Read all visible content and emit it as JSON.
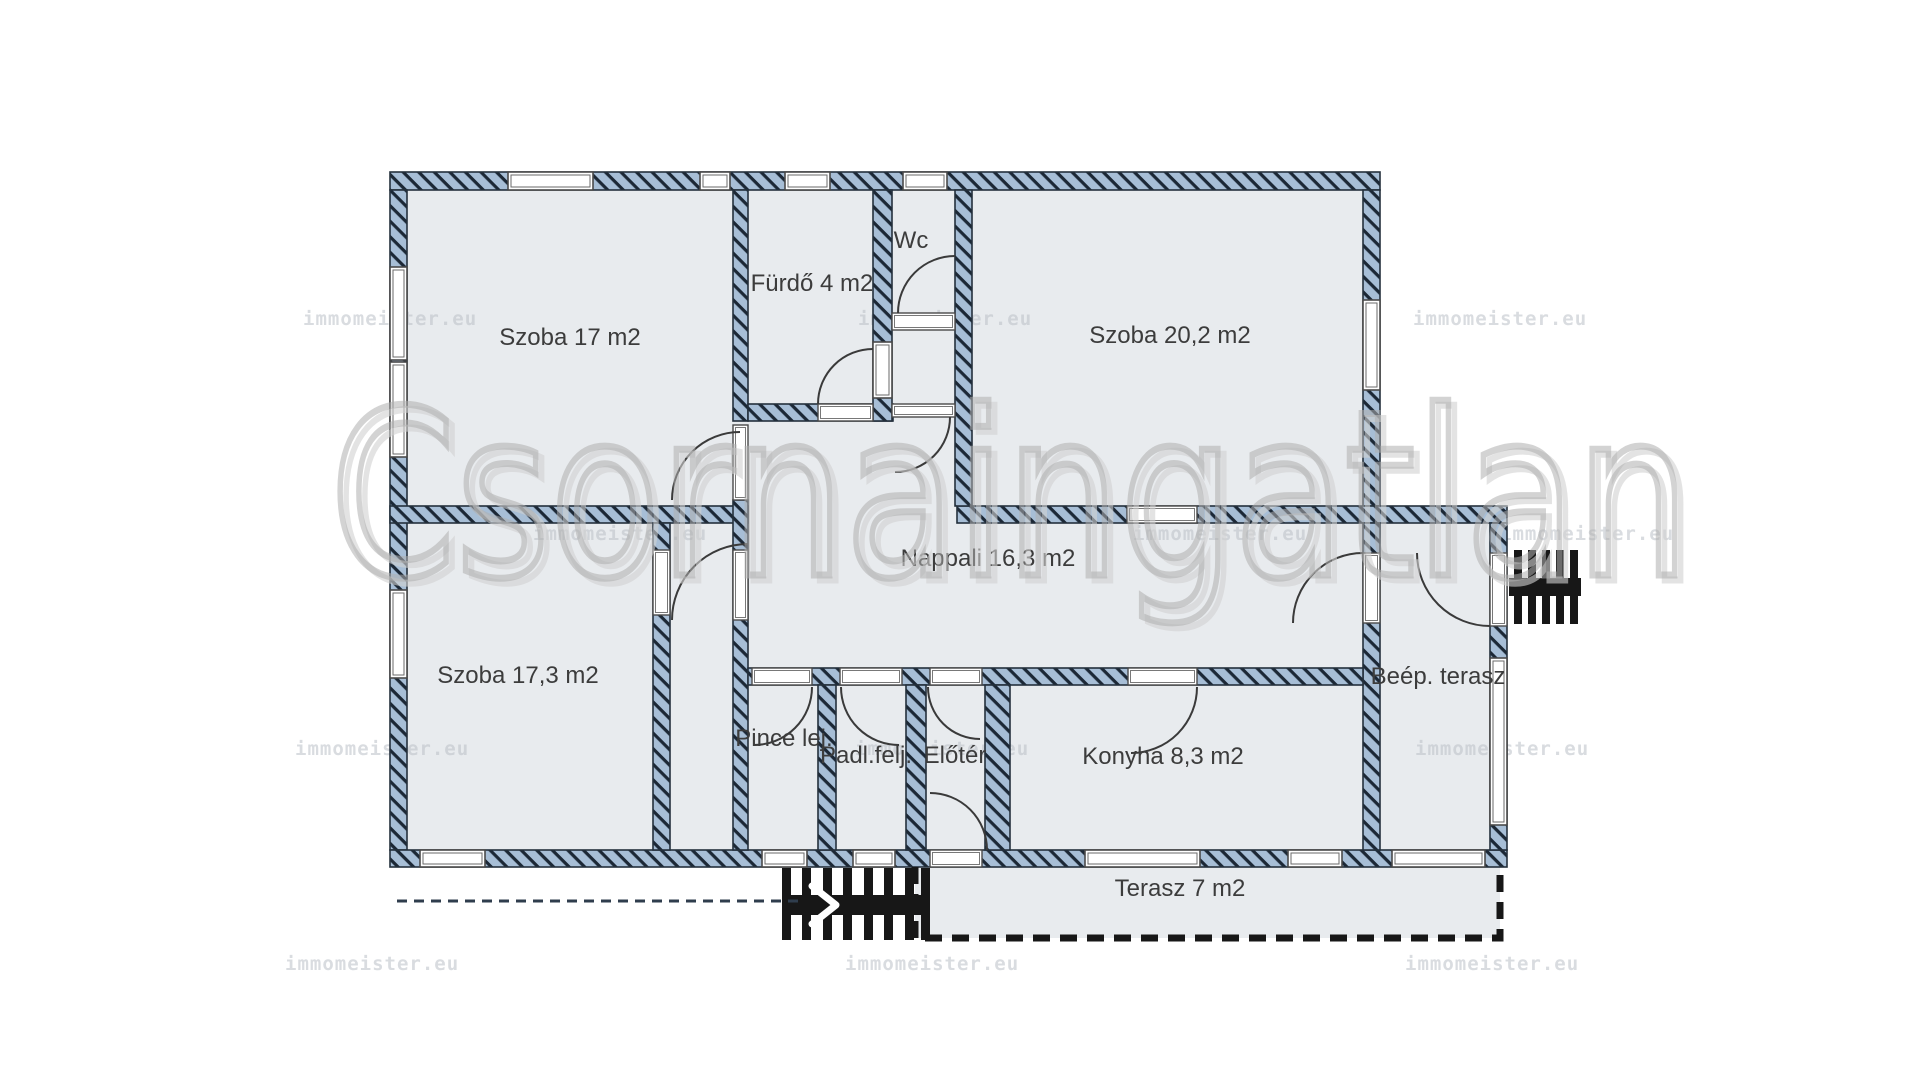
{
  "document": {
    "title": "Floor plan"
  },
  "colors": {
    "page_bg": "#ffffff",
    "room_fill": "#e8ebee",
    "wall_fill": "#a7bed6",
    "hatch_line": "#1c2836",
    "wall_stroke": "#24303c",
    "frame_stroke": "#4a4a4a",
    "frame_inner": "#6a6a6a",
    "arc_stroke": "#3a3a3a",
    "label_color": "#3c3c3c",
    "black": "#171717",
    "path_line": "#2f3d4d",
    "watermark_main": "#b0b0b0",
    "watermark_shadow": "#d2d2d2",
    "watermark_small": "rgba(185,192,199,0.55)"
  },
  "watermark": {
    "brand_text": "Csornaingatlan",
    "brand_x": 1010,
    "brand_y": 575,
    "brand_size": 230,
    "brand_length": 1360,
    "small_text": "immomeister.eu",
    "small_size": 19,
    "small_rows": [
      {
        "y": 325,
        "xs": [
          303,
          858,
          1413
        ]
      },
      {
        "y": 540,
        "xs": [
          533,
          1133,
          1500
        ]
      },
      {
        "y": 755,
        "xs": [
          295,
          855,
          1415
        ]
      },
      {
        "y": 970,
        "xs": [
          285,
          845,
          1405
        ]
      }
    ]
  },
  "rooms": [
    {
      "id": "szoba-17",
      "label": "Szoba 17 m2",
      "x": 570,
      "y": 345
    },
    {
      "id": "furdo",
      "label": "Fürdő 4 m2",
      "x": 812,
      "y": 291
    },
    {
      "id": "wc",
      "label": "Wc",
      "x": 911,
      "y": 248
    },
    {
      "id": "szoba-20-2",
      "label": "Szoba 20,2 m2",
      "x": 1170,
      "y": 343
    },
    {
      "id": "nappali",
      "label": "Nappali 16,3 m2",
      "x": 988,
      "y": 566
    },
    {
      "id": "szoba-17-3",
      "label": "Szoba 17,3 m2",
      "x": 518,
      "y": 683
    },
    {
      "id": "pince-lej",
      "label": "Pince lej.",
      "x": 784,
      "y": 746
    },
    {
      "id": "padl-felj",
      "label": "Padl.felj.",
      "x": 866,
      "y": 763
    },
    {
      "id": "eloter",
      "label": "Előtér",
      "x": 955,
      "y": 763
    },
    {
      "id": "konyha",
      "label": "Konyha 8,3 m2",
      "x": 1163,
      "y": 764
    },
    {
      "id": "beep-terasz",
      "label": "Beép. terasz",
      "x": 1438,
      "y": 684
    },
    {
      "id": "terasz",
      "label": "Terasz 7 m2",
      "x": 1180,
      "y": 896
    }
  ],
  "floorplan": {
    "label_font_size": 24,
    "footprints": [
      {
        "id": "main-block",
        "x": 390,
        "y": 172,
        "w": 990,
        "h": 695
      },
      {
        "id": "annex-block",
        "x": 1363,
        "y": 506,
        "w": 144,
        "h": 361
      }
    ],
    "terrace": {
      "x": 915,
      "y": 867,
      "w": 585,
      "h": 71,
      "dash": "17 10",
      "stroke_w": 7
    },
    "walls": [
      {
        "id": "exterior-top",
        "x": 390,
        "y": 172,
        "w": 990,
        "h": 18
      },
      {
        "id": "exterior-left",
        "x": 390,
        "y": 190,
        "w": 17,
        "h": 660
      },
      {
        "id": "exterior-bottom",
        "x": 390,
        "y": 850,
        "w": 1117,
        "h": 17
      },
      {
        "id": "exterior-right-main",
        "x": 1363,
        "y": 190,
        "w": 17,
        "h": 316
      },
      {
        "id": "band-szoba202-annex",
        "x": 957,
        "y": 506,
        "w": 550,
        "h": 17
      },
      {
        "id": "annex-right",
        "x": 1490,
        "y": 523,
        "w": 17,
        "h": 327
      },
      {
        "id": "szoba17-furdo",
        "x": 733,
        "y": 190,
        "w": 15,
        "h": 231
      },
      {
        "id": "furdo-bottom",
        "x": 748,
        "y": 404,
        "w": 145,
        "h": 17
      },
      {
        "id": "furdo-wc",
        "x": 873,
        "y": 190,
        "w": 19,
        "h": 231
      },
      {
        "id": "wc-right",
        "x": 955,
        "y": 190,
        "w": 17,
        "h": 316
      },
      {
        "id": "mid-divider-left",
        "x": 390,
        "y": 506,
        "w": 358,
        "h": 17
      },
      {
        "id": "szoba173-right",
        "x": 653,
        "y": 523,
        "w": 17,
        "h": 327
      },
      {
        "id": "stair-lobby-right",
        "x": 733,
        "y": 500,
        "w": 15,
        "h": 350
      },
      {
        "id": "nappali-annex",
        "x": 1363,
        "y": 523,
        "w": 17,
        "h": 327
      },
      {
        "id": "south-corridor-band",
        "x": 748,
        "y": 668,
        "w": 615,
        "h": 17
      },
      {
        "id": "pince-padl",
        "x": 818,
        "y": 685,
        "w": 18,
        "h": 165
      },
      {
        "id": "padl-eloter",
        "x": 906,
        "y": 685,
        "w": 20,
        "h": 165
      },
      {
        "id": "eloter-konyha",
        "x": 985,
        "y": 685,
        "w": 25,
        "h": 165
      }
    ],
    "windows": [
      {
        "id": "left-window-1",
        "x": 390,
        "y": 267,
        "w": 17,
        "h": 93
      },
      {
        "id": "left-window-2",
        "x": 390,
        "y": 362,
        "w": 17,
        "h": 95
      },
      {
        "id": "left-window-3",
        "x": 390,
        "y": 590,
        "w": 17,
        "h": 88
      },
      {
        "id": "top-window-szoba17",
        "x": 508,
        "y": 172,
        "w": 85,
        "h": 18
      },
      {
        "id": "top-window-small",
        "x": 700,
        "y": 172,
        "w": 30,
        "h": 18
      },
      {
        "id": "top-window-furdo",
        "x": 785,
        "y": 172,
        "w": 45,
        "h": 18
      },
      {
        "id": "top-window-wc",
        "x": 903,
        "y": 172,
        "w": 44,
        "h": 18
      },
      {
        "id": "right-window-szoba202",
        "x": 1363,
        "y": 300,
        "w": 17,
        "h": 90
      },
      {
        "id": "annex-right-window",
        "x": 1490,
        "y": 658,
        "w": 17,
        "h": 167
      },
      {
        "id": "furdo-wc-inner-window",
        "x": 873,
        "y": 342,
        "w": 19,
        "h": 56
      },
      {
        "id": "bottom-window-1",
        "x": 420,
        "y": 850,
        "w": 65,
        "h": 17
      },
      {
        "id": "bottom-window-2",
        "x": 762,
        "y": 850,
        "w": 45,
        "h": 17
      },
      {
        "id": "bottom-window-3",
        "x": 853,
        "y": 850,
        "w": 42,
        "h": 17
      },
      {
        "id": "konyha-window-1",
        "x": 1085,
        "y": 850,
        "w": 115,
        "h": 17
      },
      {
        "id": "konyha-window-2",
        "x": 1288,
        "y": 850,
        "w": 54,
        "h": 17
      },
      {
        "id": "annex-bottom-window",
        "x": 1392,
        "y": 850,
        "w": 93,
        "h": 17
      }
    ],
    "openings": [
      {
        "id": "szoba17-door-gap",
        "x": 733,
        "y": 425,
        "w": 15,
        "h": 75
      },
      {
        "id": "furdo-door-gap",
        "x": 818,
        "y": 404,
        "w": 55,
        "h": 17
      },
      {
        "id": "wc-door-gap",
        "x": 892,
        "y": 313,
        "w": 63,
        "h": 17
      },
      {
        "id": "nook-opening",
        "x": 892,
        "y": 404,
        "w": 63,
        "h": 13
      },
      {
        "id": "szoba202-door-gap",
        "x": 1127,
        "y": 506,
        "w": 70,
        "h": 17
      },
      {
        "id": "szoba173-door-gap",
        "x": 653,
        "y": 550,
        "w": 17,
        "h": 65
      },
      {
        "id": "lobby-door-gap",
        "x": 733,
        "y": 550,
        "w": 15,
        "h": 70
      },
      {
        "id": "annex-door-gap",
        "x": 1363,
        "y": 553,
        "w": 17,
        "h": 70
      },
      {
        "id": "annex-ext-door-gap",
        "x": 1490,
        "y": 553,
        "w": 17,
        "h": 73
      },
      {
        "id": "pince-opening",
        "x": 752,
        "y": 668,
        "w": 60,
        "h": 17
      },
      {
        "id": "padl-opening",
        "x": 840,
        "y": 668,
        "w": 62,
        "h": 17
      },
      {
        "id": "eloter-opening",
        "x": 930,
        "y": 668,
        "w": 52,
        "h": 17
      },
      {
        "id": "konyha-opening",
        "x": 1128,
        "y": 668,
        "w": 69,
        "h": 17
      },
      {
        "id": "entrance-door-gap",
        "x": 930,
        "y": 850,
        "w": 52,
        "h": 17
      }
    ],
    "doors": [
      {
        "id": "szoba17-door-arc",
        "d": "M 672 500 A 68 68 0 0 1 740 432"
      },
      {
        "id": "furdo-door-arc",
        "d": "M 818 404 A 55 55 0 0 1 873 349"
      },
      {
        "id": "wc-door-arc",
        "d": "M 898 313 A 57 57 0 0 1 955 256"
      },
      {
        "id": "nook-door-arc",
        "d": "M 950 417 A 55 55 0 0 1 895 472"
      },
      {
        "id": "lobby-door-arc",
        "d": "M 672 620 A 76 76 0 0 1 748 544"
      },
      {
        "id": "annex-door-arc",
        "d": "M 1293 623 A 70 70 0 0 1 1363 553"
      },
      {
        "id": "annex-ext-door-arc",
        "d": "M 1417 553 A 73 73 0 0 0 1490 626"
      },
      {
        "id": "pince-door-arc",
        "d": "M 812 687 A 58 58 0 0 1 754 745"
      },
      {
        "id": "padl-door-arc",
        "d": "M 841 687 A 58 58 0 0 0 899 745"
      },
      {
        "id": "eloter-door-arc",
        "d": "M 928 687 A 52 52 0 0 0 980 739"
      },
      {
        "id": "entrance-door-arc",
        "d": "M 987 850 A 57 57 0 0 0 930 793"
      },
      {
        "id": "konyha-door-arc",
        "d": "M 1197 687 A 66 66 0 0 1 1131 753"
      }
    ],
    "stairs_bottom": {
      "spine": {
        "x": 782,
        "y": 895,
        "w": 148,
        "h": 20
      },
      "teeth_y": 868,
      "teeth_h": 72,
      "teeth_w": 9,
      "teeth_x": [
        782,
        802,
        823,
        843,
        864,
        884,
        905,
        921
      ],
      "arrow": "M 812 886 L 836 905 L 812 924"
    },
    "stairs_right": {
      "spine": {
        "x": 1509,
        "y": 578,
        "w": 72,
        "h": 18
      },
      "teeth_y": 550,
      "teeth_h": 74,
      "teeth_w": 8,
      "teeth_x": [
        1514,
        1528,
        1542,
        1556,
        1570
      ]
    },
    "path_line": {
      "x1": 397,
      "y1": 901,
      "x2": 800,
      "y2": 901,
      "dash": "10 7",
      "stroke_w": 3
    }
  }
}
